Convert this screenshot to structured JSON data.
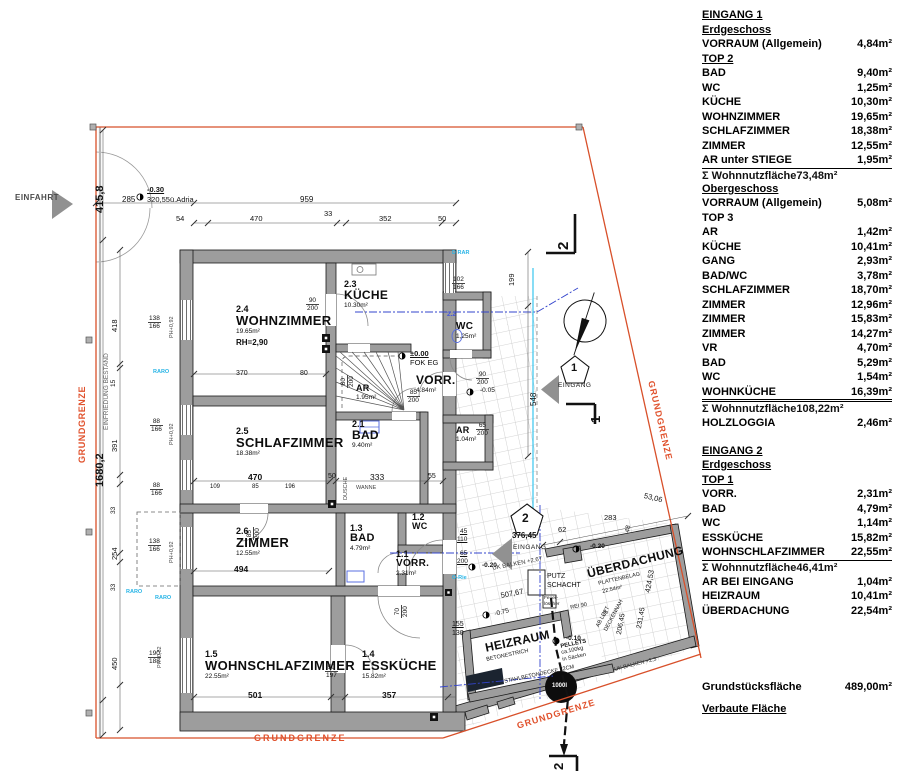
{
  "legend": {
    "rows": [
      {
        "s": "h",
        "l": "EINGANG 1"
      },
      {
        "s": "h",
        "l": "Erdgeschoss"
      },
      {
        "s": "i",
        "l": "VORRAUM (Allgemein)",
        "v": "4,84m²"
      },
      {
        "s": "h",
        "l": "TOP 2"
      },
      {
        "s": "i",
        "l": "BAD",
        "v": "9,40m²"
      },
      {
        "s": "i",
        "l": "WC",
        "v": "1,25m²"
      },
      {
        "s": "i",
        "l": "KÜCHE",
        "v": "10,30m²"
      },
      {
        "s": "i",
        "l": "WOHNZIMMER",
        "v": "19,65m²"
      },
      {
        "s": "i",
        "l": "SCHLAFZIMMER",
        "v": "18,38m²"
      },
      {
        "s": "i",
        "l": "ZIMMER",
        "v": "12,55m²"
      },
      {
        "s": "p",
        "l": "AR unter STIEGE",
        "v": "1,95m²"
      },
      {
        "s": "t",
        "l": "Σ Wohnnutzfläche",
        "v": "73,48m²"
      },
      {
        "s": "g",
        "h": 13
      },
      {
        "s": "h",
        "l": "Obergeschoss"
      },
      {
        "s": "i",
        "l": "VORRAUM (Allgemein)",
        "v": "5,08m²"
      },
      {
        "s": "b",
        "l": "TOP 3"
      },
      {
        "s": "i",
        "l": "AR",
        "v": "1,42m²"
      },
      {
        "s": "i",
        "l": "KÜCHE",
        "v": "10,41m²"
      },
      {
        "s": "i",
        "l": "GANG",
        "v": "2,93m²"
      },
      {
        "s": "i",
        "l": "BAD/WC",
        "v": "3,78m²"
      },
      {
        "s": "i",
        "l": "SCHLAFZIMMER",
        "v": "18,70m²"
      },
      {
        "s": "i",
        "l": "ZIMMER",
        "v": "12,96m²"
      },
      {
        "s": "i",
        "l": "ZIMMER",
        "v": "15,83m²"
      },
      {
        "s": "i",
        "l": "ZIMMER",
        "v": "14,27m²"
      },
      {
        "s": "i",
        "l": "VR",
        "v": "4,70m²"
      },
      {
        "s": "i",
        "l": "BAD",
        "v": "5,29m²"
      },
      {
        "s": "i",
        "l": "WC",
        "v": "1,54m²"
      },
      {
        "s": "pd",
        "l": "WOHNKÜCHE",
        "v": "16,39m²"
      },
      {
        "s": "t",
        "l": "Σ Wohnnutzfläche",
        "v": "108,22m²"
      },
      {
        "s": "g",
        "h": 14
      },
      {
        "s": "i",
        "l": "HOLZLOGGIA",
        "v": "2,46m²"
      },
      {
        "s": "g",
        "h": 13
      },
      {
        "s": "h",
        "l": "EINGANG 2"
      },
      {
        "s": "h",
        "l": "Erdgeschoss"
      },
      {
        "s": "h",
        "l": "TOP 1"
      },
      {
        "s": "i",
        "l": "VORR.",
        "v": "2,31m²"
      },
      {
        "s": "i",
        "l": "BAD",
        "v": "4,79m²"
      },
      {
        "s": "i",
        "l": "WC",
        "v": "1,14m²"
      },
      {
        "s": "i",
        "l": "ESSKÜCHE",
        "v": "15,82m²"
      },
      {
        "s": "p",
        "l": "WOHNSCHLAFZIMMER",
        "v": "22,55m²"
      },
      {
        "s": "t",
        "l": "Σ Wohnnutzfläche",
        "v": "46,41m²"
      },
      {
        "s": "g",
        "h": 14
      },
      {
        "s": "i",
        "l": "AR BEI EINGANG",
        "v": "1,04m²"
      },
      {
        "s": "i",
        "l": "HEIZRAUM",
        "v": "10,41m²"
      },
      {
        "s": "i",
        "l": "ÜBERDACHUNG",
        "v": "22,54m²"
      },
      {
        "s": "g",
        "h": 62
      },
      {
        "s": "i",
        "l": "Grundstücksfläche",
        "v": "489,00m²"
      },
      {
        "s": "g",
        "h": 7
      },
      {
        "s": "h",
        "l": "Verbaute Fläche"
      }
    ]
  },
  "plan": {
    "rooms": [
      {
        "num": "2.4",
        "name": "WOHNZIMMER",
        "area": "19.65m²",
        "note": "RH=2,90",
        "x": 236,
        "y": 305,
        "s": 13
      },
      {
        "num": "2.3",
        "name": "KÜCHE",
        "area": "10.30m²",
        "x": 344,
        "y": 280,
        "s": 12
      },
      {
        "name": "WC",
        "area": "1,25m²",
        "x": 456,
        "y": 322,
        "s": 10
      },
      {
        "num": "2.5",
        "name": "SCHLAFZIMMER",
        "area": "18.38m²",
        "x": 236,
        "y": 427,
        "s": 13
      },
      {
        "num": "2.1",
        "name": "BAD",
        "area": "9.40m²",
        "x": 352,
        "y": 420,
        "s": 12
      },
      {
        "name": "AR",
        "area": "1.04m²",
        "x": 456,
        "y": 426,
        "s": 9
      },
      {
        "num": "2.6",
        "name": "ZIMMER",
        "area": "12.55m²",
        "x": 236,
        "y": 527,
        "s": 13
      },
      {
        "num": "1.3",
        "name": "BAD",
        "area": "4.79m²",
        "x": 350,
        "y": 524,
        "s": 11
      },
      {
        "num": "1.2",
        "name": "WC",
        "x": 412,
        "y": 513,
        "s": 9
      },
      {
        "num": "1.1",
        "name": "VORR.",
        "area": "2.31m²",
        "x": 396,
        "y": 550,
        "s": 10
      },
      {
        "num": "1.5",
        "name": "WOHNSCHLAFZIMMER",
        "area": "22.55m²",
        "x": 205,
        "y": 650,
        "s": 13
      },
      {
        "num": "1.4",
        "name": "ESSKÜCHE",
        "area": "15.82m²",
        "x": 362,
        "y": 650,
        "s": 13
      },
      {
        "name": "VORR.",
        "area": "4.84m²",
        "x": 416,
        "y": 374,
        "s": 12
      },
      {
        "name": "AR",
        "area": "1.95m²",
        "x": 356,
        "y": 384,
        "s": 9
      },
      {
        "name": "HEIZRAUM",
        "x": 484,
        "y": 642,
        "s": 12,
        "r": -12
      },
      {
        "name": "ÜBERDACHUNG",
        "x": 586,
        "y": 568,
        "s": 12,
        "r": -14
      }
    ],
    "fracs": [
      {
        "a": "138",
        "b": "166",
        "x": 148,
        "y": 315
      },
      {
        "a": "88",
        "b": "166",
        "x": 150,
        "y": 418
      },
      {
        "a": "88",
        "b": "166",
        "x": 150,
        "y": 482
      },
      {
        "a": "138",
        "b": "166",
        "x": 148,
        "y": 538
      },
      {
        "a": "190",
        "b": "188",
        "x": 148,
        "y": 650
      },
      {
        "a": "102",
        "b": "166",
        "x": 452,
        "y": 276
      },
      {
        "a": "90",
        "b": "200",
        "x": 306,
        "y": 297
      },
      {
        "a": "90",
        "b": "200",
        "x": 476,
        "y": 371
      },
      {
        "a": "65",
        "b": "200",
        "x": 476,
        "y": 422
      },
      {
        "a": "85",
        "b": "200",
        "x": 407,
        "y": 389
      },
      {
        "a": "90",
        "b": "197",
        "x": 325,
        "y": 664
      },
      {
        "a": "85",
        "b": "200",
        "x": 246,
        "y": 540,
        "r": -90
      },
      {
        "a": "80",
        "b": "200",
        "x": 340,
        "y": 388,
        "r": -90
      },
      {
        "a": "70",
        "b": "200",
        "x": 394,
        "y": 618,
        "r": -90
      }
    ],
    "texts": [
      {
        "t": "EINFAHRT",
        "x": 15,
        "y": 194,
        "s": 8,
        "b": 1,
        "c": "#4a4a4a",
        "ls": 0.5,
        "n": "einfahrt-label"
      },
      {
        "t": "415,8",
        "x": 95,
        "y": 213,
        "r": -90,
        "s": 11,
        "b": 1
      },
      {
        "t": "-0.30",
        "x": 147,
        "y": 186,
        "s": 7.5,
        "b": 1,
        "u": 1
      },
      {
        "t": "320,55ü.Adria",
        "x": 147,
        "y": 196,
        "s": 7.5
      },
      {
        "t": "285",
        "x": 122,
        "y": 196,
        "s": 8
      },
      {
        "t": "959",
        "x": 300,
        "y": 196,
        "s": 8
      },
      {
        "t": "54",
        "x": 176,
        "y": 215,
        "s": 7.5
      },
      {
        "t": "470",
        "x": 250,
        "y": 215,
        "s": 7.5
      },
      {
        "t": "33",
        "x": 324,
        "y": 210,
        "s": 7.5
      },
      {
        "t": "352",
        "x": 379,
        "y": 215,
        "s": 7.5
      },
      {
        "t": "50",
        "x": 438,
        "y": 215,
        "s": 7.5
      },
      {
        "t": "GRUNDGRENZE",
        "x": 78,
        "y": 463,
        "r": -90,
        "s": 9,
        "b": 1,
        "c": "#e0512c",
        "ls": 0.6,
        "n": "grundgrenze-label-left"
      },
      {
        "t": "EINFRIEDUNG BESTAND",
        "x": 104,
        "y": 430,
        "r": -90,
        "s": 6.5,
        "c": "#666"
      },
      {
        "t": "1680,2",
        "x": 95,
        "y": 487,
        "r": -90,
        "s": 11,
        "b": 1
      },
      {
        "t": "418",
        "x": 111,
        "y": 332,
        "r": -90,
        "s": 7.5
      },
      {
        "t": "15",
        "x": 111,
        "y": 387,
        "r": -90,
        "s": 6.5
      },
      {
        "t": "391",
        "x": 111,
        "y": 452,
        "r": -90,
        "s": 7.5
      },
      {
        "t": "33",
        "x": 111,
        "y": 514,
        "r": -90,
        "s": 6.5
      },
      {
        "t": "254",
        "x": 111,
        "y": 560,
        "r": -90,
        "s": 7.5
      },
      {
        "t": "33",
        "x": 111,
        "y": 591,
        "r": -90,
        "s": 6.5
      },
      {
        "t": "450",
        "x": 111,
        "y": 670,
        "r": -90,
        "s": 7.5
      },
      {
        "t": "PH+0,92",
        "x": 170,
        "y": 338,
        "r": -90,
        "s": 5.5,
        "c": "#444"
      },
      {
        "t": "PH+0,92",
        "x": 170,
        "y": 445,
        "r": -90,
        "s": 5.5,
        "c": "#444"
      },
      {
        "t": "PH+0,92",
        "x": 170,
        "y": 563,
        "r": -90,
        "s": 5.5,
        "c": "#444"
      },
      {
        "t": "PH+0,82",
        "x": 158,
        "y": 668,
        "r": -90,
        "s": 5.5,
        "c": "#444"
      },
      {
        "t": "RARO",
        "x": 153,
        "y": 370,
        "s": 5.5,
        "c": "#28b4e6",
        "b": 1
      },
      {
        "t": "RARO",
        "x": 126,
        "y": 590,
        "s": 5.5,
        "c": "#28b4e6",
        "b": 1
      },
      {
        "t": "RARO",
        "x": 155,
        "y": 596,
        "s": 5.5,
        "c": "#28b4e6",
        "b": 1
      },
      {
        "t": "D RAR",
        "x": 452,
        "y": 251,
        "s": 5.5,
        "c": "#28b4e6",
        "b": 1
      },
      {
        "t": "O-Rie",
        "x": 452,
        "y": 576,
        "s": 5.5,
        "c": "#28b4e6",
        "b": 1
      },
      {
        "t": "370",
        "x": 236,
        "y": 370,
        "s": 7
      },
      {
        "t": "80",
        "x": 300,
        "y": 370,
        "s": 7
      },
      {
        "t": "±0.00",
        "x": 410,
        "y": 350,
        "s": 7.5,
        "b": 1,
        "u": 1
      },
      {
        "t": "FOK EG",
        "x": 410,
        "y": 359,
        "s": 7.5
      },
      {
        "t": "470",
        "x": 248,
        "y": 473,
        "s": 8.5,
        "b": 1
      },
      {
        "t": "109",
        "x": 210,
        "y": 484,
        "s": 6
      },
      {
        "t": "85",
        "x": 252,
        "y": 484,
        "s": 6
      },
      {
        "t": "196",
        "x": 285,
        "y": 484,
        "s": 6
      },
      {
        "t": "50",
        "x": 328,
        "y": 473,
        "s": 7
      },
      {
        "t": "333",
        "x": 370,
        "y": 473,
        "s": 8.5
      },
      {
        "t": "55",
        "x": 428,
        "y": 473,
        "s": 7
      },
      {
        "t": "WANNE",
        "x": 356,
        "y": 486,
        "s": 5.5,
        "c": "#444"
      },
      {
        "t": "DUSCHE",
        "x": 344,
        "y": 500,
        "r": -90,
        "s": 5.5,
        "c": "#444"
      },
      {
        "t": "494",
        "x": 234,
        "y": 565,
        "s": 8.5,
        "b": 1
      },
      {
        "t": "501",
        "x": 248,
        "y": 691,
        "s": 8.5,
        "b": 1
      },
      {
        "t": "357",
        "x": 382,
        "y": 691,
        "s": 8.5,
        "b": 1
      },
      {
        "t": "548",
        "x": 530,
        "y": 406,
        "r": -90,
        "s": 8
      },
      {
        "t": "199",
        "x": 508,
        "y": 286,
        "r": -90,
        "s": 7.5
      },
      {
        "t": "-0.05",
        "x": 480,
        "y": 388,
        "s": 6.5
      },
      {
        "t": "-0.20",
        "x": 482,
        "y": 563,
        "s": 6.5,
        "b": 1
      },
      {
        "t": "-0.20",
        "x": 590,
        "y": 544,
        "s": 6.5,
        "b": 1
      },
      {
        "t": "-0.10",
        "x": 566,
        "y": 636,
        "s": 6.5,
        "b": 1
      },
      {
        "t": "-0.75",
        "x": 494,
        "y": 612,
        "r": -15,
        "s": 6.5
      },
      {
        "t": "2.2",
        "x": 447,
        "y": 312,
        "s": 6.5,
        "c": "#4455dd",
        "b": 1
      },
      {
        "t": "376,45",
        "x": 512,
        "y": 532,
        "s": 8,
        "b": 1
      },
      {
        "t": "EINGANG",
        "x": 513,
        "y": 545,
        "s": 6.5,
        "ls": 0.5,
        "n": "eingang2-label"
      },
      {
        "t": "EINGANG",
        "x": 558,
        "y": 383,
        "s": 6.5,
        "ls": 0.5,
        "n": "eingang1-label"
      },
      {
        "t": "62",
        "x": 558,
        "y": 526,
        "s": 7.5
      },
      {
        "t": "283",
        "x": 604,
        "y": 514,
        "s": 7.5
      },
      {
        "t": "53,06",
        "x": 645,
        "y": 492,
        "r": 14,
        "s": 7.5
      },
      {
        "t": "48",
        "x": 625,
        "y": 532,
        "r": -78,
        "s": 6.5
      },
      {
        "t": "UK BALKEN +2,67",
        "x": 492,
        "y": 566,
        "r": -11,
        "s": 6,
        "c": "#333"
      },
      {
        "t": "PUTZ",
        "x": 547,
        "y": 573,
        "s": 7
      },
      {
        "t": "SCHACHT",
        "x": 547,
        "y": 582,
        "s": 7
      },
      {
        "t": "507,67",
        "x": 500,
        "y": 592,
        "r": -11,
        "s": 7.5
      },
      {
        "t": "PLATTENBELAG",
        "x": 598,
        "y": 582,
        "r": -13,
        "s": 5.5
      },
      {
        "t": "22.54m²",
        "x": 602,
        "y": 590,
        "r": -13,
        "s": 5.5
      },
      {
        "t": "424,53",
        "x": 644,
        "y": 592,
        "r": -80,
        "s": 7.5
      },
      {
        "t": "231,45",
        "x": 636,
        "y": 628,
        "r": -80,
        "s": 7
      },
      {
        "t": "206,45",
        "x": 616,
        "y": 634,
        "r": -80,
        "s": 7
      },
      {
        "t": "25",
        "x": 601,
        "y": 614,
        "r": -45,
        "s": 6
      },
      {
        "t": "AB LUFT",
        "x": 596,
        "y": 626,
        "r": -62,
        "s": 5.5
      },
      {
        "t": "DECKENNAH",
        "x": 604,
        "y": 630,
        "r": -62,
        "s": 5.5
      },
      {
        "t": "REI 90",
        "x": 570,
        "y": 606,
        "r": -11,
        "s": 5.5
      },
      {
        "t": "UK BALKEN +2,3",
        "x": 614,
        "y": 668,
        "r": -14,
        "s": 5.5,
        "c": "#333"
      },
      {
        "t": "Feuer-",
        "x": 544,
        "y": 596,
        "s": 4.8
      },
      {
        "t": "löscher",
        "x": 544,
        "y": 602,
        "s": 4.8
      },
      {
        "t": "BETONESTRICH",
        "x": 486,
        "y": 658,
        "r": -12,
        "s": 5.5
      },
      {
        "t": "PELLETS",
        "x": 560,
        "y": 644,
        "r": -12,
        "s": 5.8,
        "b": 1
      },
      {
        "t": "ca.100kg",
        "x": 561,
        "y": 651,
        "r": -12,
        "s": 5.5
      },
      {
        "t": "in Säcken",
        "x": 562,
        "y": 658,
        "r": -12,
        "s": 5.5
      },
      {
        "t": "STAHLBETONDECKE 22CM",
        "x": 504,
        "y": 680,
        "r": -12,
        "s": 5.5
      },
      {
        "t": "1000l",
        "x": 552,
        "y": 683,
        "s": 6,
        "c": "#fff",
        "b": 1,
        "n": "tank-label"
      },
      {
        "t": "GRUNDGRENZE",
        "x": 254,
        "y": 734,
        "s": 9,
        "b": 1,
        "c": "#e0512c",
        "ls": 2,
        "n": "grundgrenze-label-bottom"
      },
      {
        "t": "GRUNDGRENZE",
        "x": 516,
        "y": 722,
        "r": -17,
        "s": 9,
        "b": 1,
        "c": "#e0512c",
        "ls": 1,
        "n": "grundgrenze-label-bottomright"
      },
      {
        "t": "GRUNDGRENZE",
        "x": 655,
        "y": 380,
        "r": 77,
        "s": 9,
        "b": 1,
        "c": "#e0512c",
        "ls": 1,
        "n": "grundgrenze-label-right"
      },
      {
        "t": "45",
        "x": 460,
        "y": 529,
        "s": 6.5,
        "u": 1
      },
      {
        "t": "110",
        "x": 457,
        "y": 537,
        "s": 6.5,
        "u": 1
      },
      {
        "t": "65",
        "x": 460,
        "y": 551,
        "s": 6.5,
        "u": 1
      },
      {
        "t": "200",
        "x": 457,
        "y": 559,
        "s": 6.5,
        "u": 1
      },
      {
        "t": "155",
        "x": 452,
        "y": 621,
        "s": 7,
        "u": 1
      },
      {
        "t": "130",
        "x": 452,
        "y": 630,
        "s": 7
      },
      {
        "t": "2",
        "x": 556,
        "y": 250,
        "r": -90,
        "s": 15,
        "b": 1,
        "n": "section-mark-2-top"
      },
      {
        "t": "1",
        "x": 589,
        "y": 423,
        "r": -90,
        "s": 13,
        "b": 1,
        "n": "section-mark-1"
      },
      {
        "t": "2",
        "x": 552,
        "y": 770,
        "r": -90,
        "s": 13,
        "b": 1,
        "n": "section-mark-2-bottom"
      },
      {
        "t": "2",
        "x": 522,
        "y": 512,
        "s": 12,
        "b": 1,
        "n": "entrance-2-number"
      },
      {
        "t": "1",
        "x": 571,
        "y": 363,
        "s": 11,
        "b": 1,
        "n": "entrance-1-number"
      }
    ]
  }
}
